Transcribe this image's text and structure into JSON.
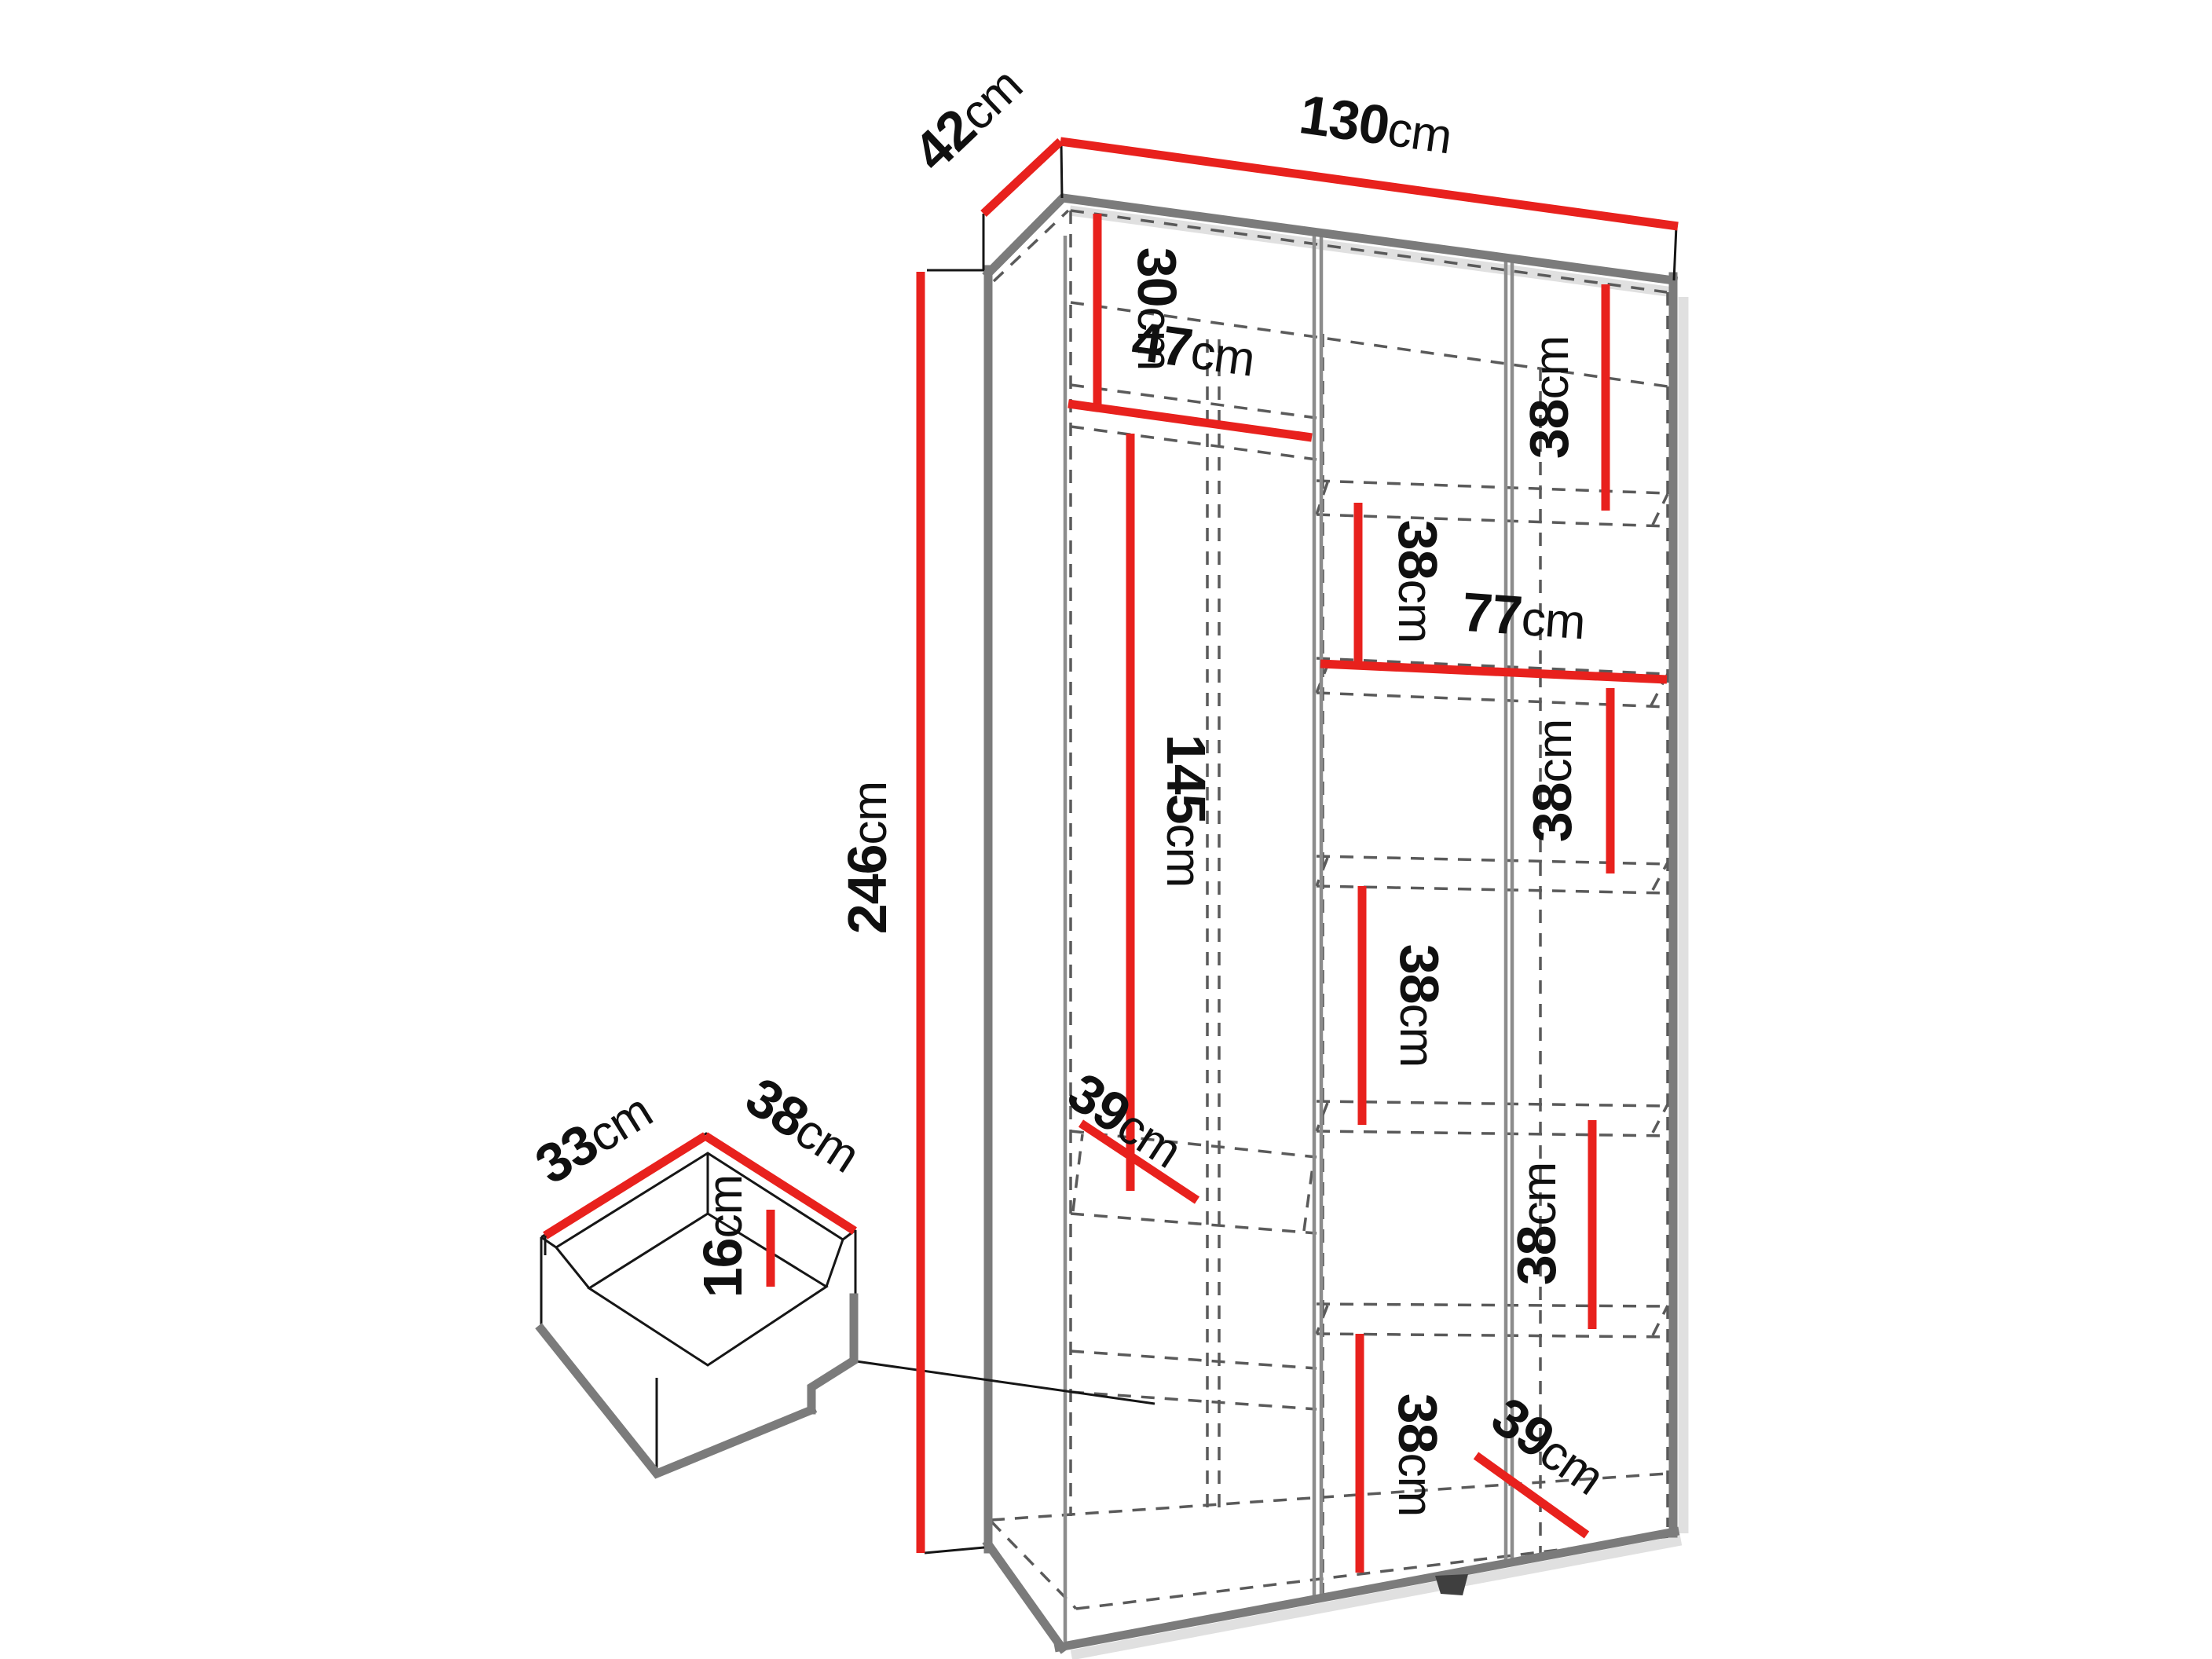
{
  "diagram": {
    "subject": "wardrobe-dimension-diagram",
    "unit": "cm",
    "colors": {
      "dimension_line": "#e8211d",
      "structure_edge": "#7b7b7b",
      "hidden_edge": "#5a5a5a",
      "label_text": "#101010",
      "background": "#ffffff"
    },
    "dims": {
      "d130": {
        "value": "130",
        "unit": "cm"
      },
      "d42": {
        "value": "42",
        "unit": "cm"
      },
      "d246": {
        "value": "246",
        "unit": "cm"
      },
      "d30": {
        "value": "30",
        "unit": "cm"
      },
      "d47": {
        "value": "47",
        "unit": "cm"
      },
      "d145": {
        "value": "145",
        "unit": "cm"
      },
      "d39_left": {
        "value": "39",
        "unit": "cm"
      },
      "d77": {
        "value": "77",
        "unit": "cm"
      },
      "d38_right_top": {
        "value": "38",
        "unit": "cm"
      },
      "d38_mid_upper": {
        "value": "38",
        "unit": "cm"
      },
      "d38_right_mid": {
        "value": "38",
        "unit": "cm"
      },
      "d38_mid_lower": {
        "value": "38",
        "unit": "cm"
      },
      "d38_right_lower": {
        "value": "38",
        "unit": "cm"
      },
      "d38_mid_bottom": {
        "value": "38",
        "unit": "cm"
      },
      "d39_right": {
        "value": "39",
        "unit": "cm"
      }
    },
    "drawer": {
      "d33": {
        "value": "33",
        "unit": "cm"
      },
      "d38": {
        "value": "38",
        "unit": "cm"
      },
      "d16": {
        "value": "16",
        "unit": "cm"
      }
    }
  }
}
